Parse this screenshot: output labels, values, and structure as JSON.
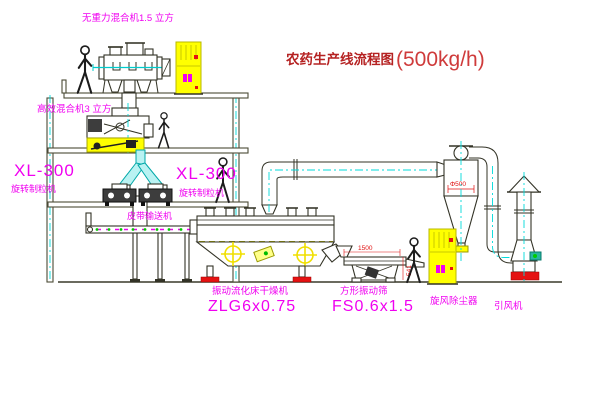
{
  "title": {
    "text": "农药生产线流程图",
    "capacity": "(500kg/h)"
  },
  "labels": {
    "mixer_top": "无重力混合机1.5 立方",
    "mixer_2f": "高效混合机3 立方",
    "granulator_left_model": "XL-300",
    "granulator_left_name": "旋转制粒机",
    "granulator_right_model": "XL-300",
    "granulator_right_name": "旋转制粒机",
    "belt_conveyor": "皮带输送机",
    "dryer_name": "振动流化床干燥机",
    "dryer_model": "ZLG6x0.75",
    "screen_name": "方形振动筛",
    "screen_model": "FS0.6x1.5",
    "cyclone": "旋风除尘器",
    "fan": "引风机"
  },
  "dimensions": {
    "cyclone_diameter": "Φ500",
    "screen_length": "1500",
    "screen_height": "541"
  },
  "colors": {
    "label_magenta": "#f000f0",
    "title_red": "#b52222",
    "line_dark": "#333326",
    "centerline_cyan": "#00dbdb",
    "cabinet_yellow": "#ffff00",
    "alert_red": "#e51212",
    "belt_green": "#00cc00"
  }
}
